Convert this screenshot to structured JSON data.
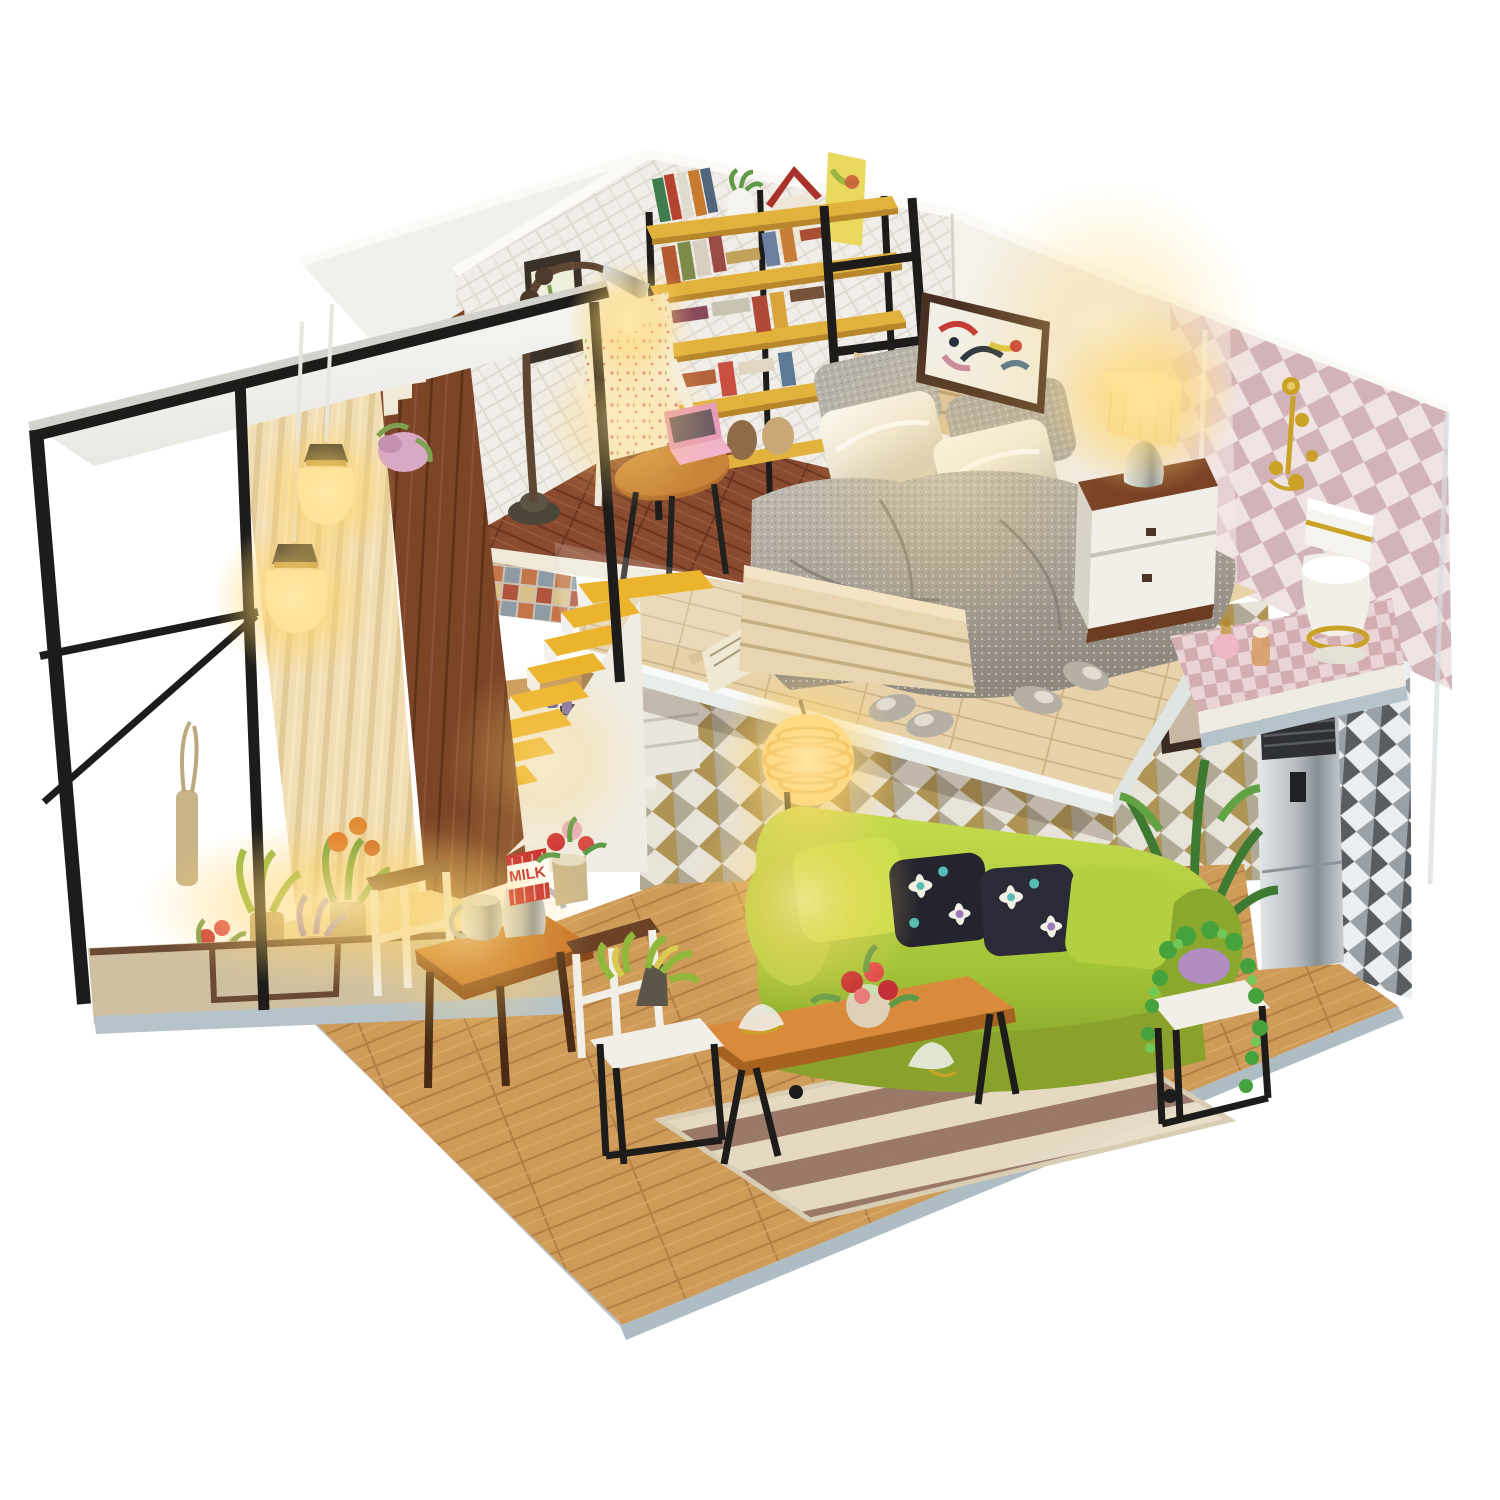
{
  "meta": {
    "description": "Photograph of a DIY miniature dollhouse loft diorama on a white background",
    "background_color": "#ffffff"
  },
  "labels": {
    "milk_carton": "MILK"
  },
  "palette": {
    "white_bg": "#ffffff",
    "wall_white": "#f1efe8",
    "brick_mortar": "#dcd6cc",
    "dark_plank_wall": "#7c4527",
    "curtain_beige": "#e9dcba",
    "living_floor_wood": "#d9a45f",
    "loft_floor_wood": "#e7d2aa",
    "study_floor_wood": "#8a4a30",
    "stair_yellow": "#ecb42c",
    "shelf_yellow": "#e2b33c",
    "frame_black": "#1d1c1a",
    "sofa_green": "#a3c437",
    "pillow_dark": "#23242e",
    "duvet_grey": "#a9a39a",
    "satin_cream": "#f3eee2",
    "nightstand_brown": "#7a4326",
    "bathroom_pink": "#e5cfd2",
    "gold_fixture": "#c9a227",
    "milk_red": "#c5252d",
    "rug_stripe": "#97776a",
    "rug_cream": "#e7dcc6",
    "base_edge_grey": "#b6c3ca",
    "warm_glow": "#ffd56e",
    "silver": "#c3c9cd"
  },
  "scene": {
    "areas": [
      {
        "name": "balcony",
        "items": [
          "white-roof-slab",
          "black-metal-frame",
          "pendant-lamps",
          "striped-curtain",
          "dark-plank-wall",
          "flower-decal",
          "stair-step-art",
          "potted-plants",
          "stepped-base"
        ]
      },
      {
        "name": "reading-nook",
        "items": [
          "whitewashed-brick-wall",
          "framed-botanical-print",
          "arc-floor-lamp",
          "floral-armchair",
          "round-wood-table",
          "pink-laptop",
          "yellow-bookshelf",
          "books",
          "white-vase",
          "red-roof-birdhouse",
          "leaning-poster",
          "black-ladder"
        ]
      },
      {
        "name": "loft-bedroom",
        "items": [
          "pale-wood-platform",
          "acrylic-railing",
          "double-bed",
          "slat-headboard",
          "grey-knit-pillows",
          "white-satin-pillows",
          "grey-knit-duvet",
          "slat-footboard",
          "open-booklet",
          "knit-slippers",
          "nightstand",
          "glowing-table-lamp",
          "abstract-painting"
        ]
      },
      {
        "name": "bathroom",
        "items": [
          "diamond-wallpaper",
          "gold-wall-fixtures",
          "white-toilet-gold-trim",
          "perfume-bottles",
          "checkered-platform"
        ]
      },
      {
        "name": "kitchen",
        "items": [
          "yellow-stairs",
          "mosaic-backsplash",
          "wood-counter",
          "black-oven",
          "white-cabinets",
          "blue-jars"
        ]
      },
      {
        "name": "living-room",
        "items": [
          "triangle-wallpaper",
          "silver-air-conditioner",
          "green-fabric-sofa",
          "floral-cushions",
          "ribbed-pendant-globe",
          "long-coffee-bench",
          "glass-lotus-bowls",
          "red-flower-arrangement",
          "striped-rug",
          "white-side-table",
          "trailing-plant",
          "leafy-plant",
          "dining-table",
          "silver-kettles",
          "milk-carton",
          "flower-tin",
          "white-frame-chairs",
          "cube-stool-with-plant"
        ]
      }
    ]
  }
}
